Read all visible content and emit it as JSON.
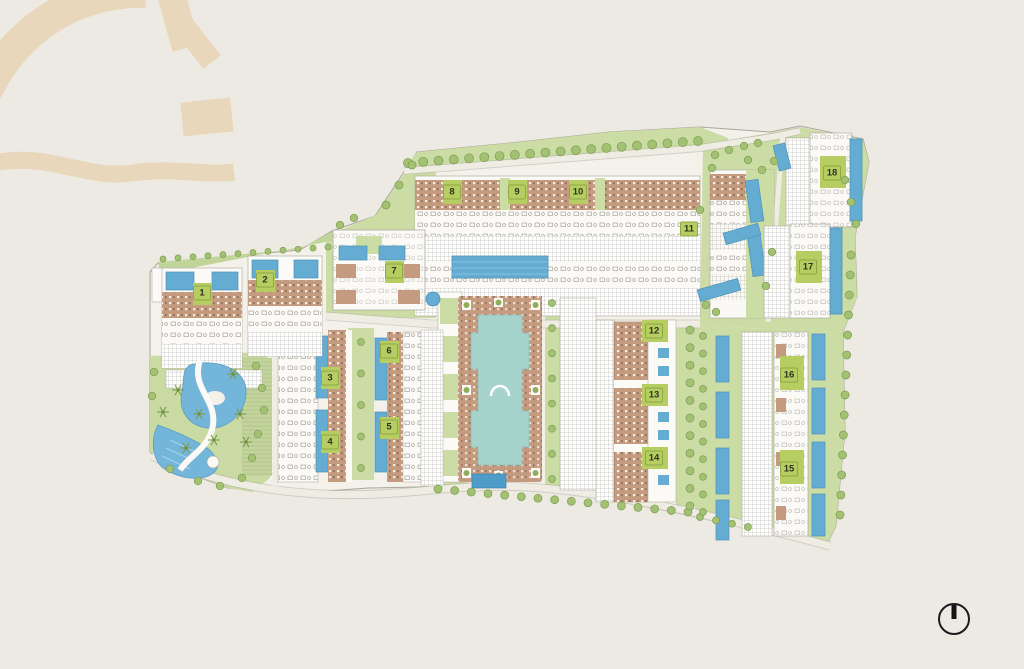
{
  "page": {
    "title": "Resort residential masterplan site map",
    "background_color": "#ECEAE3"
  },
  "watermark": {
    "icon": "arch-dome-logo-watermark",
    "color": "#E8D7BA"
  },
  "masterplan": {
    "markers": [
      {
        "label": "1",
        "x": 202,
        "y": 293
      },
      {
        "label": "2",
        "x": 265,
        "y": 280
      },
      {
        "label": "3",
        "x": 330,
        "y": 378
      },
      {
        "label": "4",
        "x": 330,
        "y": 442
      },
      {
        "label": "5",
        "x": 389,
        "y": 427
      },
      {
        "label": "6",
        "x": 389,
        "y": 351
      },
      {
        "label": "7",
        "x": 394,
        "y": 271
      },
      {
        "label": "8",
        "x": 452,
        "y": 192
      },
      {
        "label": "9",
        "x": 517,
        "y": 192
      },
      {
        "label": "10",
        "x": 578,
        "y": 192
      },
      {
        "label": "11",
        "x": 689,
        "y": 229
      },
      {
        "label": "12",
        "x": 654,
        "y": 331
      },
      {
        "label": "13",
        "x": 654,
        "y": 395
      },
      {
        "label": "14",
        "x": 654,
        "y": 458
      },
      {
        "label": "15",
        "x": 789,
        "y": 469
      },
      {
        "label": "16",
        "x": 789,
        "y": 375
      },
      {
        "label": "17",
        "x": 808,
        "y": 267
      },
      {
        "label": "18",
        "x": 832,
        "y": 173
      }
    ],
    "marker_style": {
      "background": "#B6CD62",
      "text_color": "#2F3520"
    },
    "palette": {
      "site_base": "#F3F1EA",
      "greenery": "#CBDCA4",
      "tree": "#A3C172",
      "roof_tan": "#C59B80",
      "pool_blue": "#64ACD2",
      "lagoon_blue": "#74B6DA",
      "central_pool_aqua": "#A6D3CB",
      "road": "#EFECE4",
      "hatch_gray": "#9B988F"
    },
    "features": {
      "central_courtyard_pool": "central-courtyard-pool",
      "lagoon_pool": "lagoon-leisure-pool",
      "perimeter_trees": "tree-rows",
      "north_indicator": "compass"
    }
  },
  "compass": {
    "icon": "north-compass-icon",
    "color": "#1B1B1B"
  }
}
